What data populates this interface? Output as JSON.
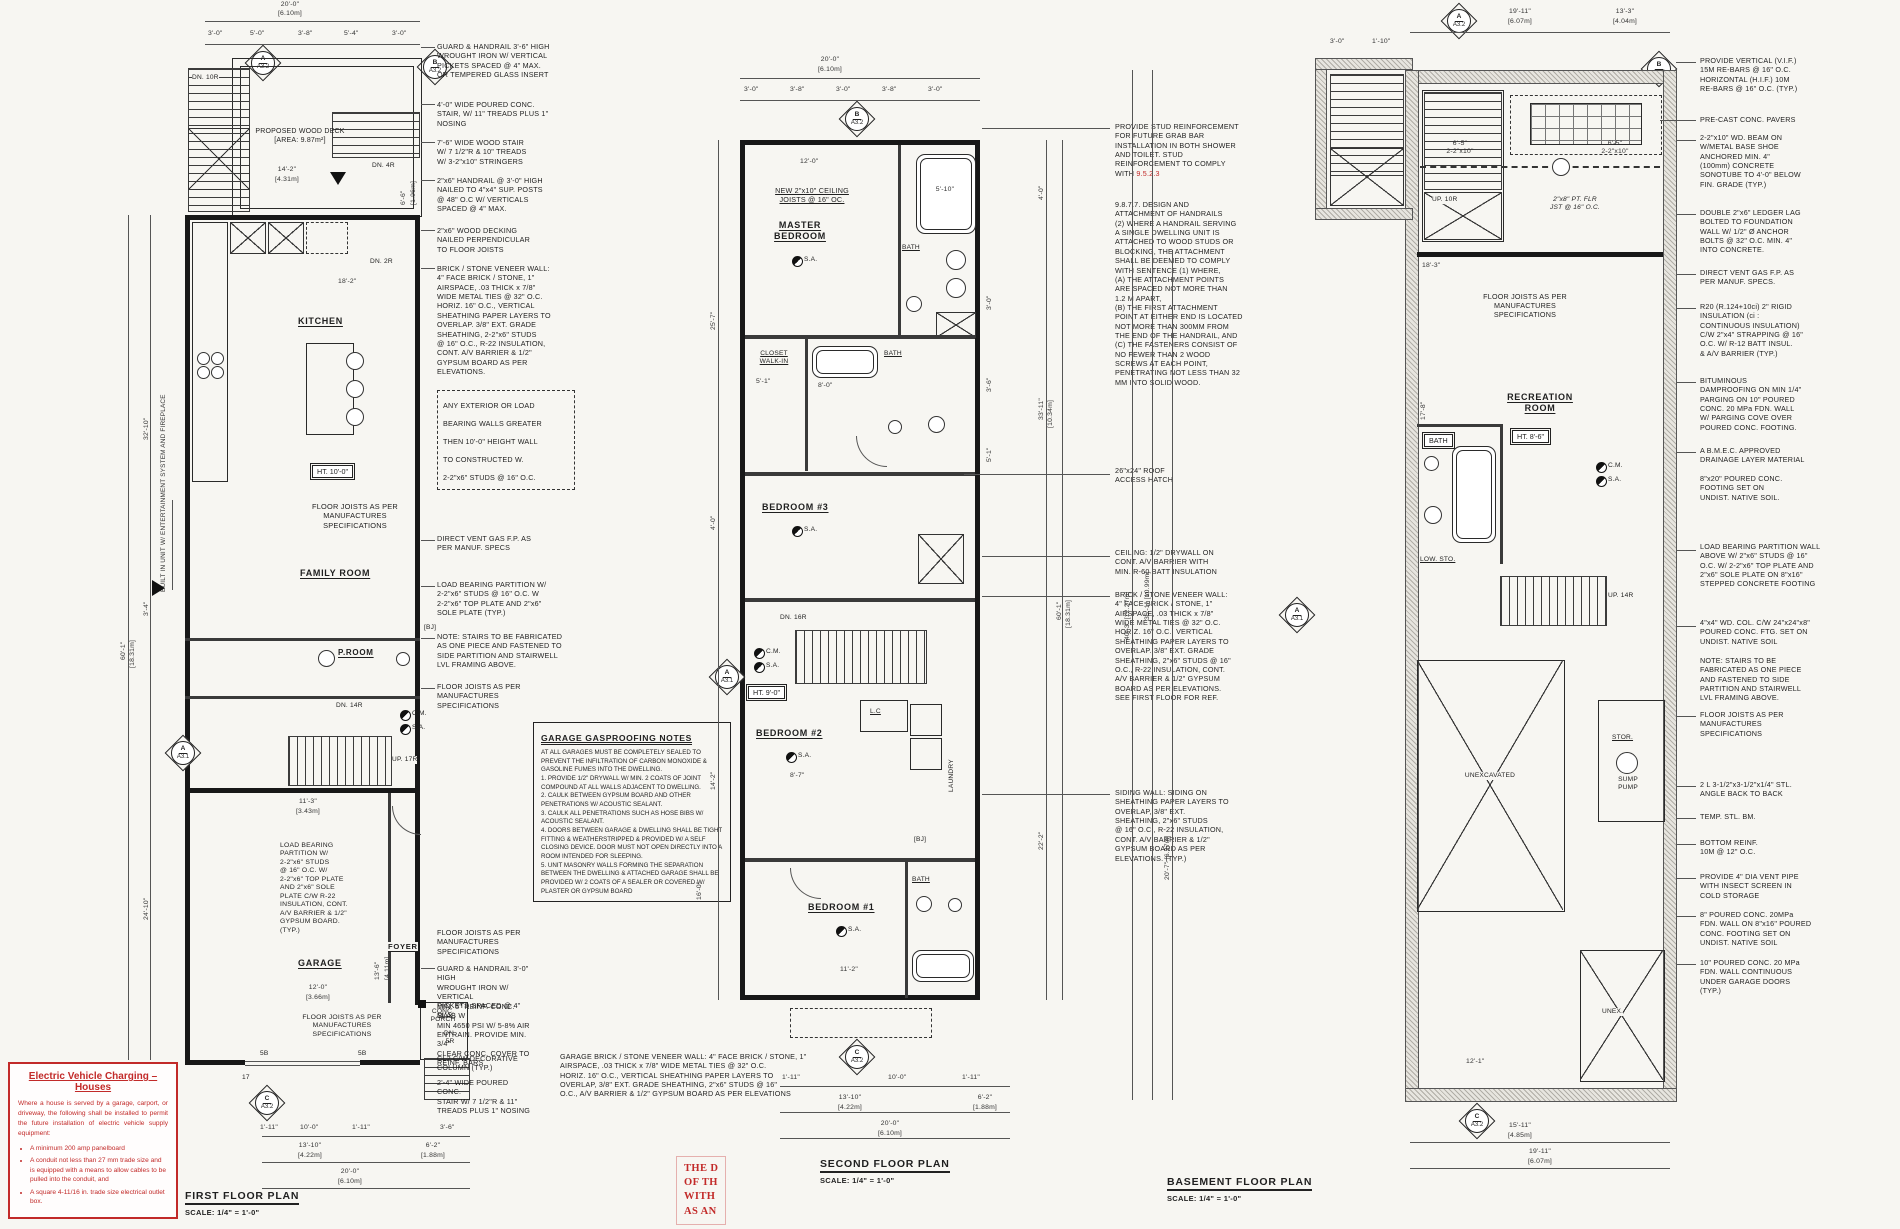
{
  "sheet": {
    "bg": "#f7f6f2",
    "ink": "#1f1f1f",
    "accent_red": "#c22a29"
  },
  "legend": {
    "cm": "C.M.",
    "sa": "S.A."
  },
  "markers": {
    "a": "A",
    "b": "B",
    "c": "C",
    "s32": "A3.2",
    "s31": "A3.1"
  },
  "plan1": {
    "title": "FIRST FLOOR PLAN",
    "scale": "SCALE: 1/4\" = 1'-0\"",
    "labels": {
      "deck": "PROPOSED WOOD DECK\n[AREA: 9.87m²]",
      "dn10": "DN. 10R",
      "dn4": "DN. 4R",
      "dn2": "DN. 2R",
      "dn14": "DN. 14R",
      "up17": "UP. 17R",
      "dn5": "DN.\n5R",
      "kitchen": "KITCHEN",
      "family": "FAMILY ROOM",
      "proom": "P.ROOM",
      "garage": "GARAGE",
      "foyer": "FOYER",
      "porch": "CONC.\nPORCH",
      "ht": "HT. 10'-0\"",
      "joists": "FLOOR JOISTS AS PER\nMANUFACTURES\nSPECIFICATIONS",
      "builtin": "BUILT IN UNIT W/ ENTERTAINMENT SYSTEM AND FIREPLACE",
      "partition": "LOAD BEARING\nPARTITION W/\n2-2\"x6\" STUDS\n@ 16\" O.C. W/\n2-2\"x6\" TOP PLATE\nAND 2\"x6\" SOLE\nPLATE C/W R-22\nINSULATION, CONT.\nA/V BARRIER & 1/2\"\nGYPSUM BOARD.\n(TYP.)",
      "bj": "[BJ]",
      "b5a": "5B",
      "b5b": "5B",
      "t17": "17"
    },
    "dims": {
      "top": "20'-0\"",
      "topm": "[6.10m]",
      "s1": "3'-0\"",
      "s2": "5'-0\"",
      "s3": "3'-8\"",
      "s4": "5'-4\"",
      "s5": "3'-0\"",
      "deckw": "14'-2\"",
      "deckwm": "[4.31m]",
      "deckd": "18'-2\"",
      "side": "6'-6\"",
      "sidem": "[1.96m]",
      "l1": "60'-1\"",
      "l1m": "[18.31m]",
      "l2": "32'-10\"",
      "l3": "3'-4\"",
      "l4": "24'-10\"",
      "gar1": "11'-3\"",
      "gar1m": "[3.43m]",
      "gar2": "12'-0\"",
      "gar2m": "[3.66m]",
      "gar3": "13'-6\"",
      "gar3m": "[4.11m]",
      "b1": "1'-11\"",
      "b2": "10'-0\"",
      "b3": "1'-11\"",
      "b4": "3'-6\"",
      "b5": "13'-10\"",
      "b5m": "[4.22m]",
      "b6": "6'-2\"",
      "b6m": "[1.88m]",
      "b7": "20'-0\"",
      "b7m": "[6.10m]"
    },
    "annotations": [
      "GUARD & HANDRAIL 3'-6\" HIGH\nWROUGHT IRON W/ VERTICAL\nPICKETS SPACED @ 4\" MAX.\nOR TEMPERED GLASS INSERT",
      "4'-0\" WIDE POURED CONC.\nSTAIR, W/ 11\" TREADS PLUS 1\"\nNOSING",
      "7'-6\" WIDE WOOD STAIR\nW/ 7 1/2\"R & 10\" TREADS\nW/ 3-2\"x10\" STRINGERS",
      "2\"x6\" HANDRAIL @ 3'-0\" HIGH\nNAILED TO 4\"x4\" SUP. POSTS\n@ 48\" O.C W/ VERTICALS\nSPACED @ 4\" MAX.",
      "2\"x6\" WOOD DECKING\nNAILED PERPENDICULAR\nTO FLOOR JOISTS",
      "BRICK / STONE VENEER WALL:\n4\" FACE BRICK / STONE, 1\"\nAIRSPACE, .03 THICK x 7/8\"\nWIDE METAL TIES @ 32\" O.C.\nHORIZ. 16\" O.C., VERTICAL\nSHEATHING PAPER LAYERS TO\nOVERLAP. 3/8\" EXT. GRADE\nSHEATHING, 2-2\"x6\" STUDS\n@ 16\" O.C., R-22 INSULATION,\nCONT. A/V BARRIER & 1/2\"\nGYPSUM BOARD AS PER\nELEVATIONS.",
      "ANY EXTERIOR OR LOAD\nBEARING WALLS GREATER\nTHEN 10'-0\" HEIGHT WALL\nTO CONSTRUCTED W.\n2-2\"x6\" STUDS @ 16\" O.C.",
      "DIRECT VENT GAS F.P. AS\nPER MANUF. SPECS",
      "LOAD BEARING PARTITION W/\n2-2\"x6\" STUDS @ 16\" O.C. W\n2-2\"x6\" TOP PLATE AND 2\"x6\"\nSOLE PLATE (TYP.)",
      "NOTE: STAIRS TO BE FABRICATED\nAS ONE PIECE AND FASTENED TO\nSIDE PARTITION AND STAIRWELL\nLVL FRAMING ABOVE.",
      "FLOOR JOISTS AS PER\nMANUFACTURES\nSPECIFICATIONS",
      "FLOOR JOISTS AS PER\nMANUFACTURES\nSPECIFICATIONS",
      "GUARD & HANDRAIL 3'-0\" HIGH\nWROUGHT IRON W/ VERTICAL\nPICKETS SPACED @ 4\" MAX.",
      "MIN. 5\" REINF. CONC. SLAB W\nMIN 4650 PSI W/ 5-8% AIR\nENTRAIN. PROVIDE MIN. 3/4\"\nCLEAR CONC. COVER TO\nREINF. BARS",
      "CL2 C/W DECORATIVE\nCOLUMN (TYP.)",
      "2'-4\" WIDE POURED CONC.\nSTAIR W/ 7 1/2\"R & 11\"\nTREADS PLUS 1\" NOSING",
      "GARAGE BRICK / STONE VENEER WALL: 4\" FACE BRICK / STONE, 1\"\nAIRSPACE, .03 THICK x 7/8\" WIDE METAL TIES @ 32\" O.C.\nHORIZ. 16\" O.C., VERTICAL SHEATHING PAPER LAYERS TO\nOVERLAP, 3/8\" EXT. GRADE SHEATHING, 2\"x6\" STUDS @ 16\"\nO.C., A/V BARRIER & 1/2\" GYPSUM BOARD AS PER ELEVATIONS"
    ],
    "notes_title": "GARAGE GASPROOFING NOTES",
    "notes_body": "AT ALL GARAGES MUST BE COMPLETELY SEALED TO PREVENT THE INFILTRATION OF CARBON MONOXIDE & GASOLINE FUMES INTO THE DWELLING.\n1. PROVIDE 1/2\" DRYWALL W/ MIN. 2 COATS OF JOINT COMPOUND AT ALL WALLS ADJACENT TO DWELLING.\n2. CAULK BETWEEN GYPSUM BOARD AND OTHER PENETRATIONS W/ ACOUSTIC SEALANT.\n3. CAULK ALL PENETRATIONS SUCH AS HOSE BIBS W/ ACOUSTIC SEALANT.\n4. DOORS BETWEEN GARAGE & DWELLING SHALL BE TIGHT FITTING & WEATHERSTRIPPED & PROVIDED W/ A SELF CLOSING DEVICE. DOOR MUST NOT OPEN DIRECTLY INTO A ROOM INTENDED FOR SLEEPING.\n5. UNIT MASONRY WALLS FORMING THE SEPARATION BETWEEN THE DWELLING & ATTACHED GARAGE SHALL BE PROVIDED W/ 2 COATS OF A SEALER OR COVERED W/ PLASTER OR GYPSUM BOARD"
  },
  "plan2": {
    "title": "SECOND FLOOR PLAN",
    "scale": "SCALE: 1/4\" = 1'-0\"",
    "labels": {
      "joists": "NEW 2\"x10\" CEILING\nJOISTS @ 16\" OC.",
      "master": "MASTER\nBEDROOM",
      "closet": "CLOSET\nWALK-IN",
      "bath": "BATH",
      "bed3": "BEDROOM #3",
      "bed2": "BEDROOM #2",
      "bed1": "BEDROOM #1",
      "lc": "L.C",
      "laundry": "LAUNDRY",
      "dn16": "DN. 16R",
      "ht": "HT. 9'-0\"",
      "bj": "[BJ]"
    },
    "dims": {
      "top": "20'-0\"",
      "topm": "[6.10m]",
      "s1": "3'-0\"",
      "s2": "3'-8\"",
      "s3": "3'-0\"",
      "s4": "3'-8\"",
      "s5": "3'-0\"",
      "l1": "25'-7\"",
      "l2": "4'-0\"",
      "l3": "14'-2\"",
      "l4": "16'-0\"",
      "r1": "60'-1\"",
      "r1m": "[18.31m]",
      "r2": "33'-11\"",
      "r2m": "[10.34m]",
      "r3": "4'-0\"",
      "r4": "22'-2\"",
      "rs1": "3'-0\"",
      "rs2": "3'-6\"",
      "rs3": "5'-1\"",
      "tub": "5'-10\"",
      "bath": "8'-0\"",
      "closet": "5'-1\"",
      "mbr": "12'-0\"",
      "bed2": "8'-7\"",
      "bed1": "11'-2\"",
      "b1": "1'-11\"",
      "b2": "10'-0\"",
      "b3": "1'-11\"",
      "b4": "13'-10\"",
      "b4m": "[4.22m]",
      "b5": "6'-2\"",
      "b5m": "[1.88m]",
      "b6": "20'-0\"",
      "b6m": "[6.10m]"
    },
    "a0": "PROVIDE STUD REINFORCEMENT\nFOR FUTURE GRAB BAR\nINSTALLATION IN BOTH SHOWER\nAND TOILET. STUD\nREINFORCEMENT TO COMPLY\nWITH ",
    "a0_ref": "9.5.2.3",
    "a1": "9.8.7.7. DESIGN AND\nATTACHMENT OF HANDRAILS\n(2) WHERE A HANDRAIL SERVING\nA SINGLE DWELLING UNIT IS\nATTACHED TO WOOD STUDS OR\nBLOCKING, THE ATTACHMENT\nSHALL BE DEEMED TO COMPLY\nWITH SENTENCE (1) WHERE,\n(A) THE ATTACHMENT POINTS\nARE SPACED NOT MORE THAN\n1.2 M APART,\n(B) THE FIRST ATTACHMENT\nPOINT AT EITHER END IS LOCATED\nNOT MORE THAN 300MM FROM\nTHE END OF THE HANDRAIL, AND\n(C) THE FASTENERS CONSIST OF\nNO FEWER THAN 2 WOOD\nSCREWS AT EACH POINT,\nPENETRATING NOT LESS THAN 32\nMM INTO SOLID WOOD.",
    "a2": "26\"x24\" ROOF\nACCESS HATCH",
    "a3": "CEILING: 1/2\" DRYWALL ON\nCONT. A/V BARRIER WITH\nMIN. R-60 BATT INSULATION",
    "a4": "BRICK / STONE VENEER WALL:\n4\" FACE BRICK / STONE, 1\"\nAIRSPACE, .03 THICK x 7/8\"\nWIDE METAL TIES @ 32\" O.C.\nHORIZ. 16\" O.C., VERTICAL\nSHEATHING PAPER LAYERS TO\nOVERLAP. 3/8\" EXT. GRADE\nSHEATHING, 2\"x6\" STUDS @ 16\"\nO.C., R-22 INSULATION, CONT.\nA/V BARRIER & 1/2\" GYPSUM\nBOARD AS PER ELEVATIONS.\nSEE FIRST FLOOR FOR REF.",
    "a5": "SIDING WALL: SIDING ON\nSHEATHING PAPER LAYERS TO\nOVERLAP, 3/8\" EXT.\nSHEATHING, 2\"x6\" STUDS\n@ 16\" O.C., R-22 INSULATION,\nCONT. A/V BARRIER & 1/2\"\nGYPSUM BOARD AS PER\nELEVATIONS. (TYP.)"
  },
  "plan3": {
    "title": "BASEMENT FLOOR PLAN",
    "scale": "SCALE: 1/4\" = 1'-0\"",
    "labels": {
      "up10": "UP. 10R",
      "up14": "UP. 14R",
      "pt": "2\"x8\" PT. FLR\nJST @ 16\" O.C.",
      "joists": "FLOOR JOISTS AS PER\nMANUFACTURES\nSPECIFICATIONS",
      "rec": "RECREATION\nROOM",
      "ht": "HT. 8'-6\"",
      "bath": "BATH",
      "low": "LOW. STO.",
      "unex": "UNEXCAVATED",
      "stor": "STOR.",
      "sump": "SUMP\nPUMP",
      "unex2": "UNEX."
    },
    "dims": {
      "t1": "19'-11\"",
      "t1m": "[6.07m]",
      "t2": "13'-3\"",
      "t2m": "[4.04m]",
      "bp1": "3'-0\"",
      "bp2": "1'-10\"",
      "l1": "40'-3\" [12.27m]",
      "l2": "36'-1\" [10.99m]",
      "l3": "20'-7\" [6.27m]",
      "l4": "17'-8\"",
      "beam": "6'-5\"\n2-2\"x10\"",
      "fr": "18'-3\"",
      "und": "12'-1\"",
      "b1": "15'-11\"",
      "b1m": "[4.85m]",
      "b2": "19'-11\"",
      "b2m": "[6.07m]"
    },
    "annotations": [
      "PROVIDE VERTICAL (V.I.F.)\n15M RE-BARS @ 16\" O.C.\nHORIZONTAL (H.I.F.) 10M\nRE-BARS @ 16\" O.C. (TYP.)",
      "PRE-CAST CONC. PAVERS",
      "2-2\"x10\" WD. BEAM ON\nW/METAL BASE SHOE\nANCHORED MIN. 4\"\n(100mm) CONCRETE\nSONOTUBE TO 4'-0\" BELOW\nFIN. GRADE (TYP.)",
      "DOUBLE 2\"x6\" LEDGER LAG\nBOLTED TO FOUNDATION\nWALL W/ 1/2\" Ø ANCHOR\nBOLTS @ 32\" O.C. MIN. 4\"\nINTO CONCRETE.",
      "DIRECT VENT GAS F.P. AS\nPER MANUF. SPECS.",
      "R20 (R.124+10ci) 2\" RIGID\nINSULATION (ci :\nCONTINUOUS INSULATION)\nC/W 2\"x4\" STRAPPING @ 16\"\nO.C. W/ R-12 BATT INSUL.\n& A/V BARRIER (TYP.)",
      "BITUMINOUS\nDAMPROOFING ON MIN 1/4\"\nPARGING ON 10\" POURED\nCONC. 20 MPa FDN. WALL\nW/ PARGING COVE OVER\nPOURED CONC. FOOTING.",
      "A B.M.E.C. APPROVED\nDRAINAGE LAYER MATERIAL",
      "8\"x20\" POURED CONC.\nFOOTING SET ON\nUNDIST. NATIVE SOIL.",
      "LOAD BEARING PARTITION WALL\nABOVE W/ 2\"x6\" STUDS @ 16\"\nO.C. W/ 2-2\"x6\" TOP PLATE AND\n2\"x6\" SOLE PLATE ON 8\"x16\"\nSTEPPED CONCRETE FOOTING",
      "4\"x4\" WD. COL. C/W 24\"x24\"x8\"\nPOURED CONC. FTG. SET ON\nUNDIST. NATIVE SOIL",
      "NOTE: STAIRS TO BE\nFABRICATED AS ONE PIECE\nAND FASTENED TO SIDE\nPARTITION AND STAIRWELL\nLVL FRAMING ABOVE.",
      "FLOOR JOISTS AS PER\nMANUFACTURES\nSPECIFICATIONS",
      "2 L 3-1/2\"x3-1/2\"x1/4\" STL.\nANGLE BACK TO BACK",
      "TEMP. STL. BM.",
      "BOTTOM REINF.\n10M @ 12\" O.C.",
      "PROVIDE 4\" DIA VENT PIPE\nWITH INSECT SCREEN IN\nCOLD STORAGE",
      "8\" POURED CONC. 20MPa\nFDN. WALL ON 8\"x16\" POURED\nCONC. FOOTING SET ON\nUNDIST. NATIVE SOIL",
      "10\" POURED CONC. 20 MPa\nFDN. WALL CONTINUOUS\nUNDER GARAGE DOORS\n(TYP.)"
    ]
  },
  "ev": {
    "title": "Electric Vehicle Charging – Houses",
    "body": "Where a house is served by a garage, carport, or driveway, the following shall be installed to permit the future installation of electric vehicle supply equipment:",
    "b1": "A minimum 200 amp panelboard",
    "b2": "A conduit not less than 27 mm trade size and is equipped with a means to allow cables to be pulled into the conduit, and",
    "b3": "A square 4-11/16 in. trade size electrical outlet box.",
    "stamp": "THE D\nOF TH\nWITH\nAS AN"
  }
}
